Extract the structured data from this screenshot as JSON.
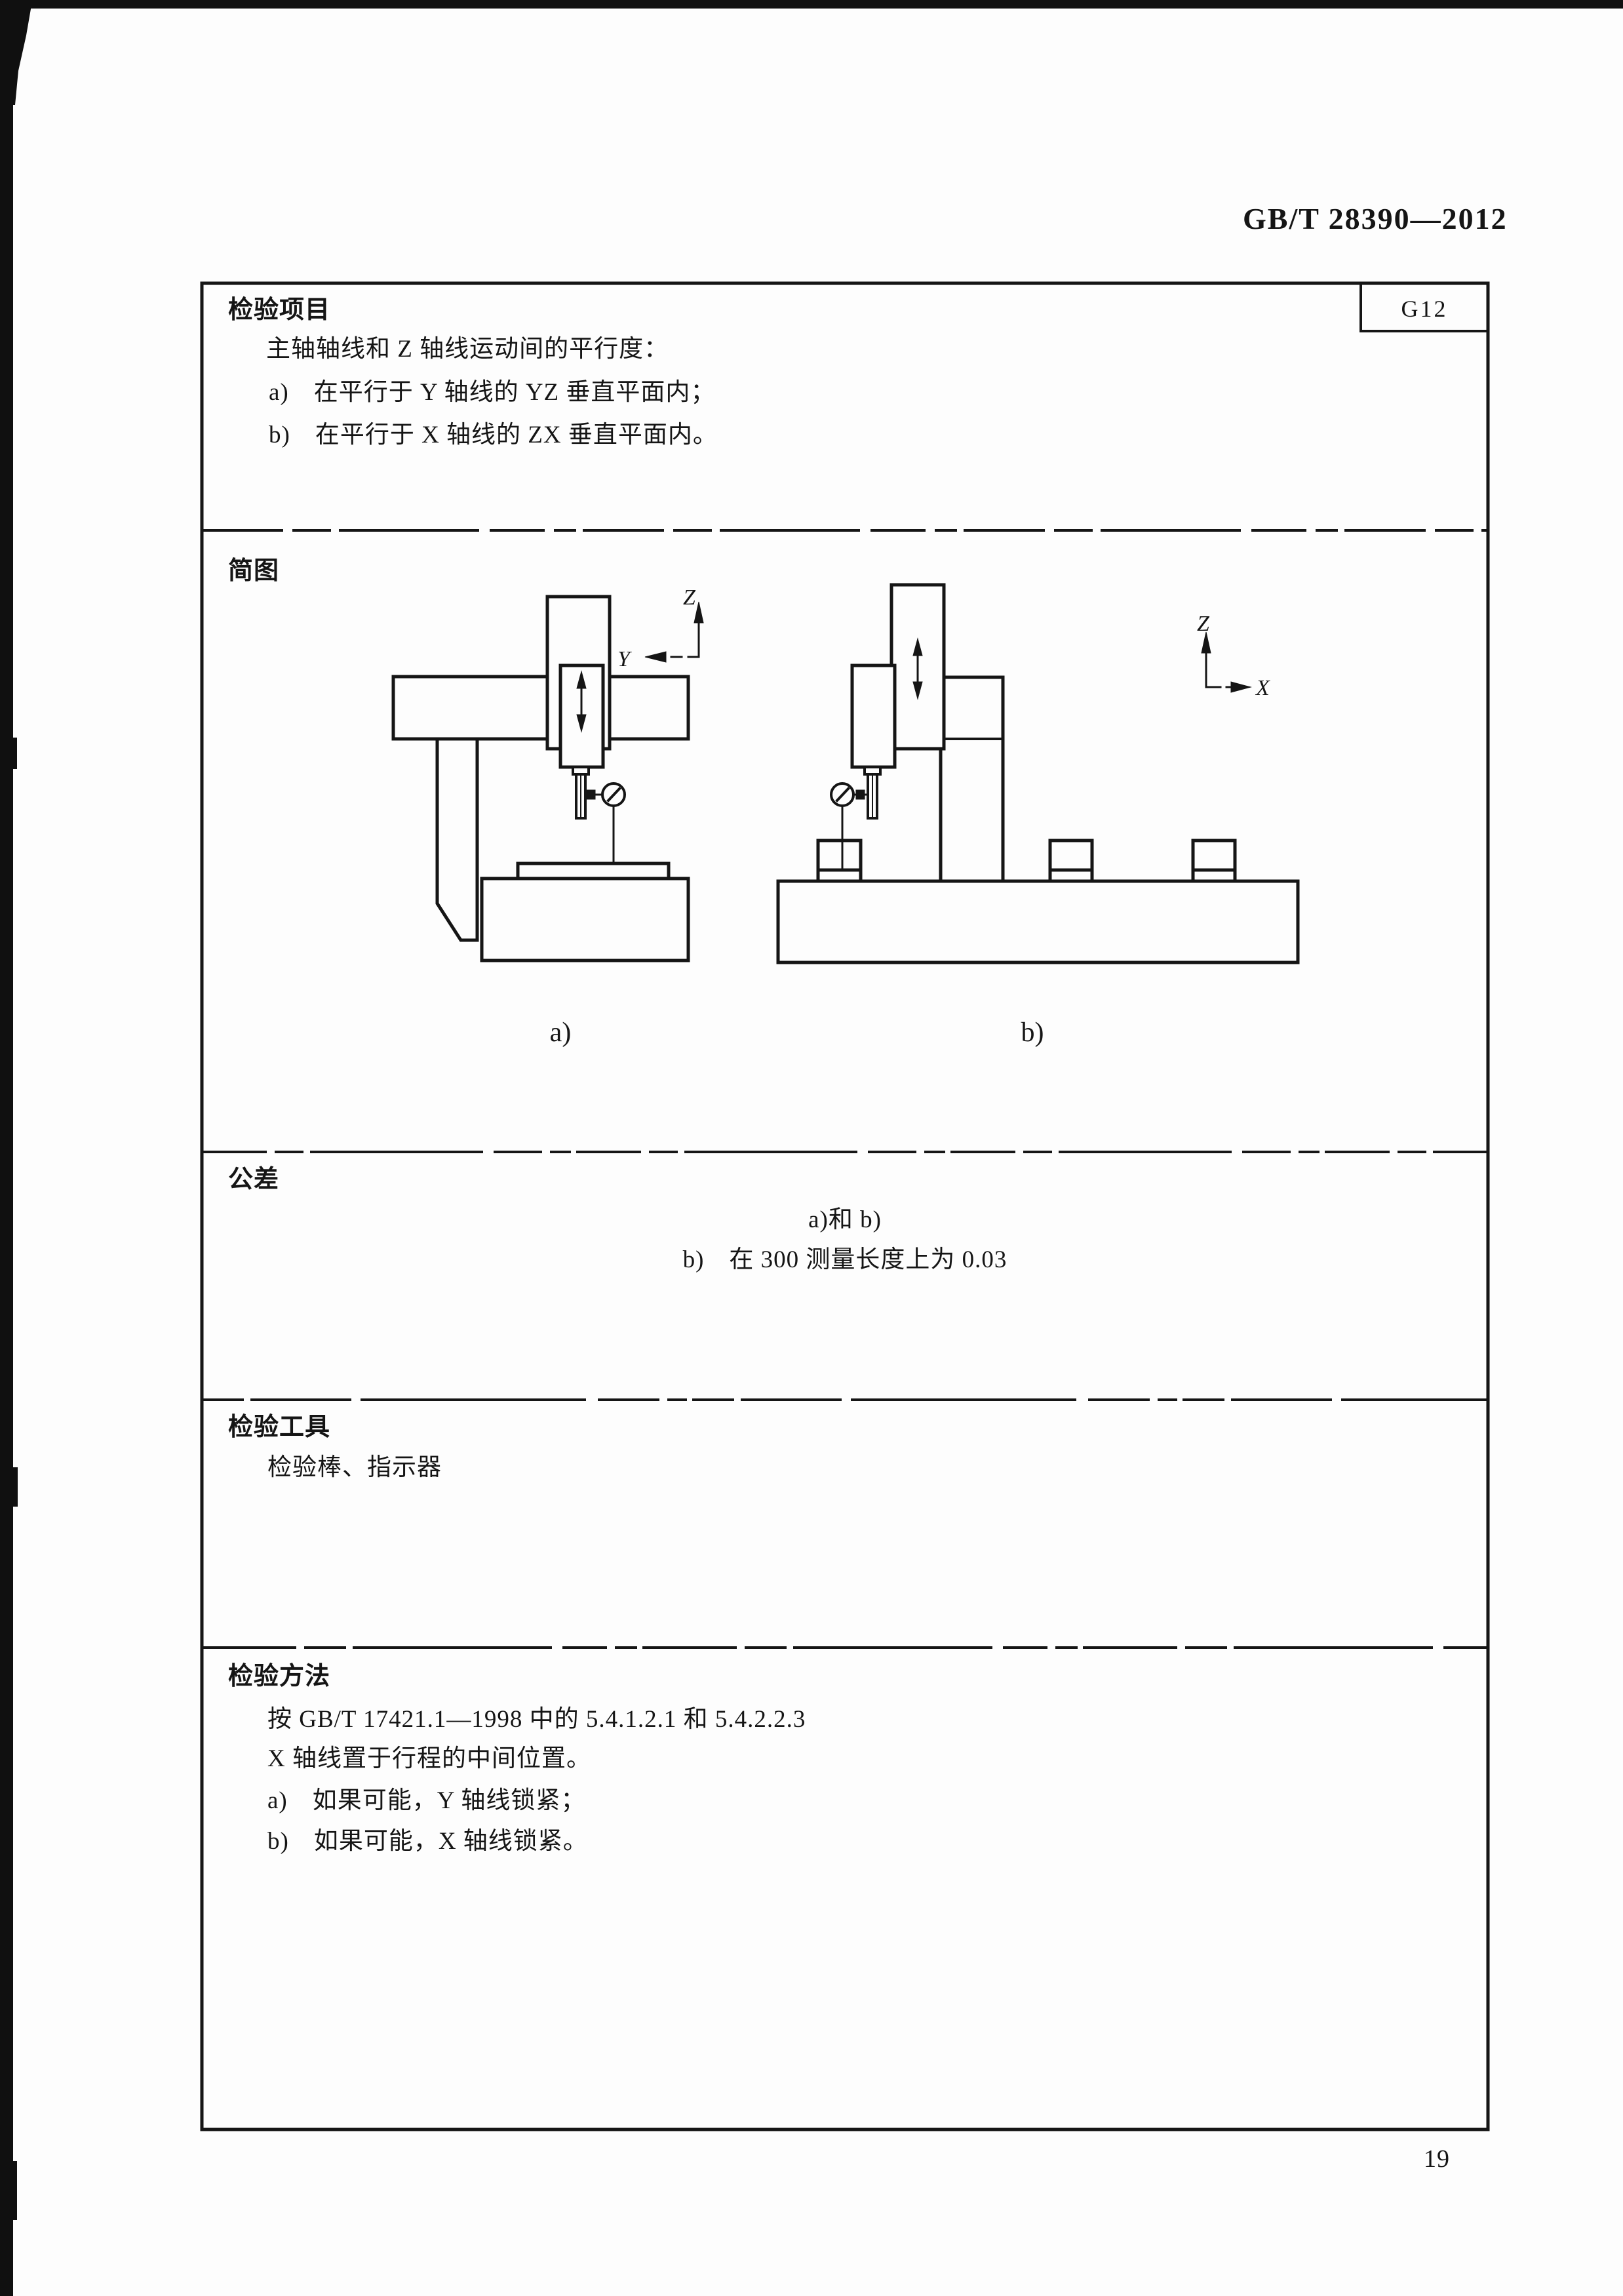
{
  "page": {
    "header": "GB/T 28390—2012",
    "page_number": "19"
  },
  "table": {
    "inspection_item": {
      "label": "检验项目",
      "code": "G12",
      "intro": "主轴轴线和 Z 轴线运动间的平行度：",
      "item_a": "a)　在平行于 Y 轴线的 YZ 垂直平面内；",
      "item_b": "b)　在平行于 X 轴线的 ZX 垂直平面内。"
    },
    "diagram": {
      "label": "简图",
      "caption_a": "a)",
      "caption_b": "b)",
      "axes": {
        "z": "Z",
        "y": "Y",
        "x": "X"
      }
    },
    "tolerance": {
      "label": "公差",
      "line_1": "a)和 b)",
      "line_2": "b)　在 300 测量长度上为 0.03"
    },
    "tools": {
      "label": "检验工具",
      "content": "检验棒、指示器"
    },
    "method": {
      "label": "检验方法",
      "line_1": "按 GB/T 17421.1—1998 中的 5.4.1.2.1 和 5.4.2.2.3",
      "line_2": "X 轴线置于行程的中间位置。",
      "line_3": "a)　如果可能，Y 轴线锁紧；",
      "line_4": "b)　如果可能，X 轴线锁紧。"
    }
  }
}
